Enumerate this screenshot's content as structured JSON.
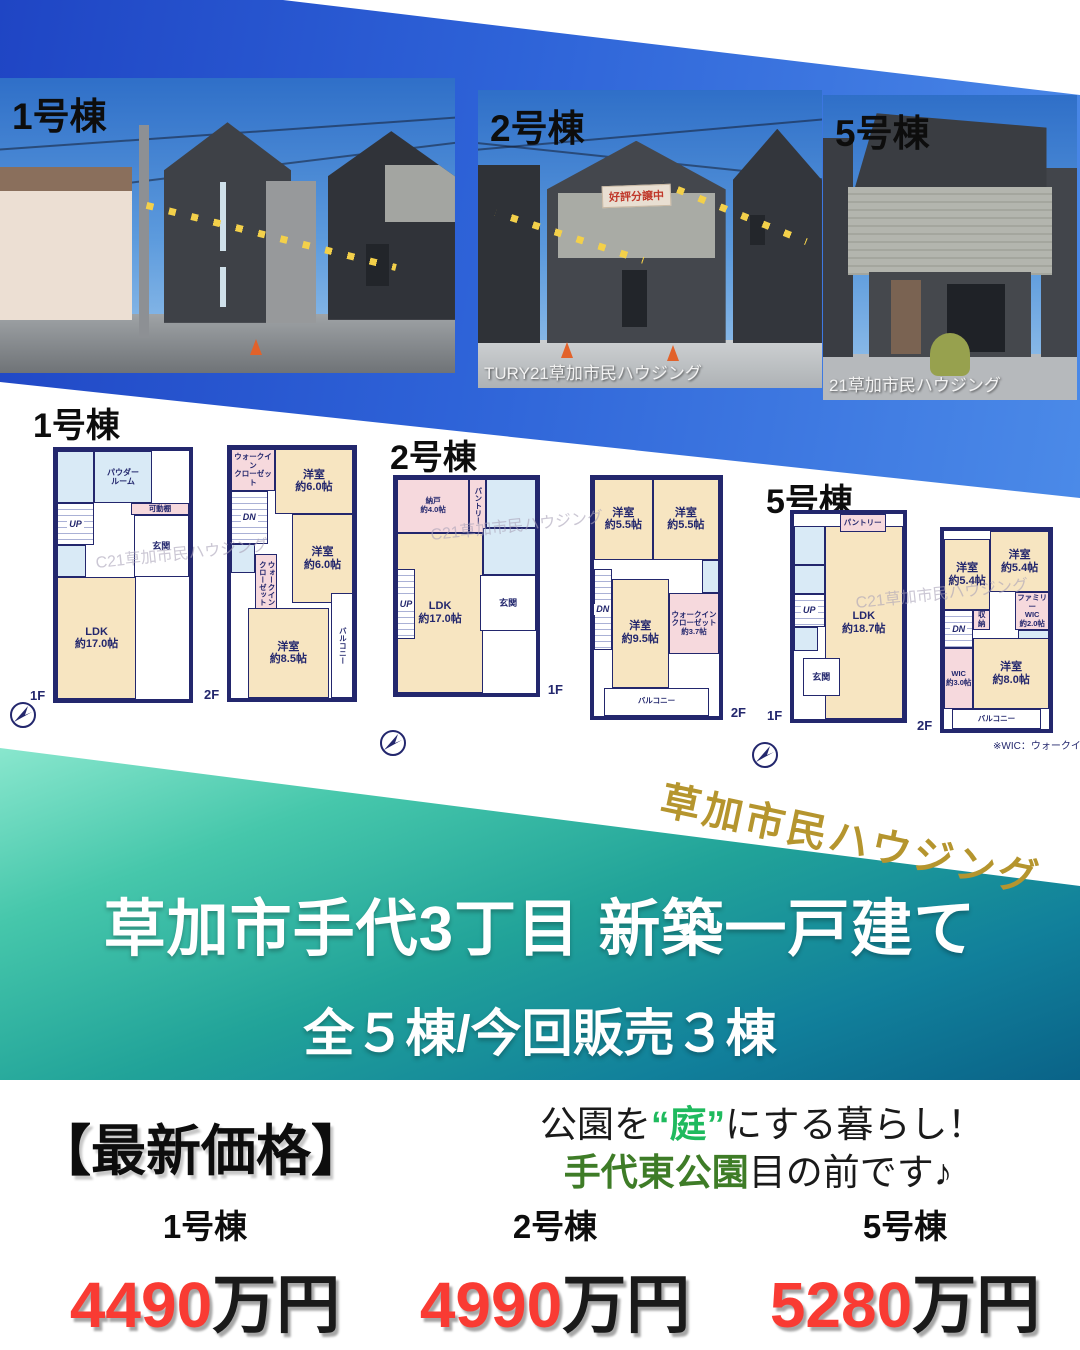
{
  "photos": [
    {
      "label": "1号棟",
      "watermark": "",
      "sale_banner": ""
    },
    {
      "label": "2号棟",
      "watermark": "TURY21草加市民ハウジング",
      "sale_banner": "好評分譲中"
    },
    {
      "label": "5号棟",
      "watermark": "21草加市民ハウジング",
      "sale_banner": ""
    }
  ],
  "plan_watermark": "C21草加市民ハウジング",
  "wic_note": "※WIC：ウォークインクローゼ",
  "plans": [
    {
      "label": "1号棟",
      "floors": [
        {
          "tag": "1F",
          "rooms": [
            {
              "t": "room",
              "x": 0,
              "y": 51,
              "w": 60,
              "h": 49,
              "label": "LDK\n約17.0帖"
            },
            {
              "t": "wet",
              "x": 0,
              "y": 0,
              "w": 28,
              "h": 21,
              "label": ""
            },
            {
              "t": "wet",
              "x": 28,
              "y": 0,
              "w": 44,
              "h": 21,
              "label": "パウダー\nルーム"
            },
            {
              "t": "shelf",
              "x": 56,
              "y": 21,
              "w": 44,
              "h": 5,
              "label": "可動棚"
            },
            {
              "t": "stairs",
              "x": 0,
              "y": 21,
              "w": 28,
              "h": 17,
              "label": "UP"
            },
            {
              "t": "wet",
              "x": 0,
              "y": 38,
              "w": 22,
              "h": 13,
              "label": ""
            },
            {
              "t": "hall",
              "x": 58,
              "y": 26,
              "w": 42,
              "h": 25,
              "label": "玄関"
            }
          ]
        },
        {
          "tag": "2F",
          "rooms": [
            {
              "t": "closet",
              "x": 0,
              "y": 0,
              "w": 36,
              "h": 17,
              "label": "ウォークイン\nクローゼット"
            },
            {
              "t": "room",
              "x": 36,
              "y": 0,
              "w": 64,
              "h": 26,
              "label": "洋室\n約6.0帖"
            },
            {
              "t": "stairs",
              "x": 0,
              "y": 17,
              "w": 30,
              "h": 21,
              "label": "DN"
            },
            {
              "t": "wet",
              "x": 0,
              "y": 38,
              "w": 20,
              "h": 12,
              "label": ""
            },
            {
              "t": "closet",
              "x": 20,
              "y": 42,
              "w": 18,
              "h": 24,
              "label": "ウォークイン\nクローゼット",
              "vert": true
            },
            {
              "t": "room",
              "x": 50,
              "y": 26,
              "w": 50,
              "h": 36,
              "label": "洋室\n約6.0帖"
            },
            {
              "t": "room",
              "x": 14,
              "y": 64,
              "w": 66,
              "h": 36,
              "label": "洋室\n約8.5帖"
            },
            {
              "t": "balcony",
              "x": 82,
              "y": 58,
              "w": 18,
              "h": 42,
              "label": "バルコニー",
              "vert": true
            }
          ]
        }
      ]
    },
    {
      "label": "2号棟",
      "floors": [
        {
          "tag": "1F",
          "rooms": [
            {
              "t": "room",
              "x": 0,
              "y": 25,
              "w": 62,
              "h": 75,
              "label": "LDK\n約17.0帖"
            },
            {
              "t": "closet",
              "x": 0,
              "y": 0,
              "w": 52,
              "h": 25,
              "label": "納戸\n約4.0帖"
            },
            {
              "t": "closet",
              "x": 52,
              "y": 0,
              "w": 12,
              "h": 25,
              "label": "パントリー",
              "vert": true
            },
            {
              "t": "wet",
              "x": 64,
              "y": 0,
              "w": 36,
              "h": 23,
              "label": ""
            },
            {
              "t": "wet",
              "x": 62,
              "y": 23,
              "w": 38,
              "h": 22,
              "label": ""
            },
            {
              "t": "hall",
              "x": 60,
              "y": 45,
              "w": 40,
              "h": 26,
              "label": "玄関"
            },
            {
              "t": "stairs",
              "x": 0,
              "y": 42,
              "w": 13,
              "h": 33,
              "label": "UP"
            }
          ]
        },
        {
          "tag": "2F",
          "rooms": [
            {
              "t": "room",
              "x": 0,
              "y": 0,
              "w": 47,
              "h": 34,
              "label": "洋室\n約5.5帖"
            },
            {
              "t": "room",
              "x": 47,
              "y": 0,
              "w": 53,
              "h": 34,
              "label": "洋室\n約5.5帖"
            },
            {
              "t": "stairs",
              "x": 0,
              "y": 38,
              "w": 14,
              "h": 34,
              "label": "DN"
            },
            {
              "t": "wet",
              "x": 86,
              "y": 34,
              "w": 14,
              "h": 14,
              "label": ""
            },
            {
              "t": "closet",
              "x": 60,
              "y": 48,
              "w": 40,
              "h": 26,
              "label": "ウォークイン\nクローゼット\n約3.7帖"
            },
            {
              "t": "room",
              "x": 14,
              "y": 42,
              "w": 46,
              "h": 46,
              "label": "洋室\n約9.5帖"
            },
            {
              "t": "balcony",
              "x": 8,
              "y": 88,
              "w": 84,
              "h": 12,
              "label": "バルコニー"
            }
          ]
        }
      ]
    },
    {
      "label": "5号棟",
      "floors": [
        {
          "tag": "1F",
          "rooms": [
            {
              "t": "room",
              "x": 28,
              "y": 6,
              "w": 72,
              "h": 94,
              "label": "LDK\n約18.7帖"
            },
            {
              "t": "closet",
              "x": 42,
              "y": 0,
              "w": 42,
              "h": 9,
              "label": "パントリー"
            },
            {
              "t": "wet",
              "x": 0,
              "y": 6,
              "w": 28,
              "h": 19,
              "label": ""
            },
            {
              "t": "wet",
              "x": 0,
              "y": 25,
              "w": 28,
              "h": 14,
              "label": ""
            },
            {
              "t": "stairs",
              "x": 0,
              "y": 39,
              "w": 28,
              "h": 16,
              "label": "UP"
            },
            {
              "t": "wet",
              "x": 0,
              "y": 55,
              "w": 22,
              "h": 12,
              "label": ""
            },
            {
              "t": "hall",
              "x": 8,
              "y": 70,
              "w": 34,
              "h": 19,
              "label": "玄関"
            }
          ]
        },
        {
          "tag": "2F",
          "rooms": [
            {
              "t": "room",
              "x": 0,
              "y": 4,
              "w": 44,
              "h": 36,
              "label": "洋室\n約5.4帖"
            },
            {
              "t": "room",
              "x": 44,
              "y": 0,
              "w": 56,
              "h": 31,
              "label": "洋室\n約5.4帖"
            },
            {
              "t": "closet",
              "x": 68,
              "y": 31,
              "w": 32,
              "h": 19,
              "label": "ファミリー\nWIC\n約2.0帖"
            },
            {
              "t": "stairs",
              "x": 0,
              "y": 40,
              "w": 28,
              "h": 19,
              "label": "DN"
            },
            {
              "t": "closet",
              "x": 28,
              "y": 40,
              "w": 16,
              "h": 10,
              "label": "収納"
            },
            {
              "t": "wet",
              "x": 70,
              "y": 50,
              "w": 30,
              "h": 12,
              "label": ""
            },
            {
              "t": "room",
              "x": 28,
              "y": 54,
              "w": 72,
              "h": 36,
              "label": "洋室\n約8.0帖"
            },
            {
              "t": "closet",
              "x": 0,
              "y": 59,
              "w": 28,
              "h": 31,
              "label": "WIC\n約3.0帖"
            },
            {
              "t": "balcony",
              "x": 8,
              "y": 90,
              "w": 84,
              "h": 10,
              "label": "バルコニー"
            }
          ]
        }
      ]
    }
  ],
  "brand": "草加市民ハウジング",
  "banner": {
    "title": "草加市手代3丁目 新築一戸建て",
    "subtitle": "全５棟/今回販売３棟"
  },
  "price_section": {
    "heading": "【最新価格】",
    "catch_line1_pre": "公園を",
    "catch_line1_hl": "“庭”",
    "catch_line1_post": "にする暮らし！",
    "catch_line2_hl": "手代東公園",
    "catch_line2_post": "目の前です♪",
    "items": [
      {
        "name": "1号棟",
        "amount": "4490",
        "unit": "万円"
      },
      {
        "name": "2号棟",
        "amount": "4990",
        "unit": "万円"
      },
      {
        "name": "5号棟",
        "amount": "5280",
        "unit": "万円"
      }
    ]
  },
  "colors": {
    "accent_red": "#f93b33",
    "highlight_green": "#1fba5e",
    "park_green": "#3e7c27",
    "brand_gold": "#b5952e",
    "wall_navy": "#23276d",
    "top_blue": "#2e63d8",
    "teal": "#21a399"
  }
}
